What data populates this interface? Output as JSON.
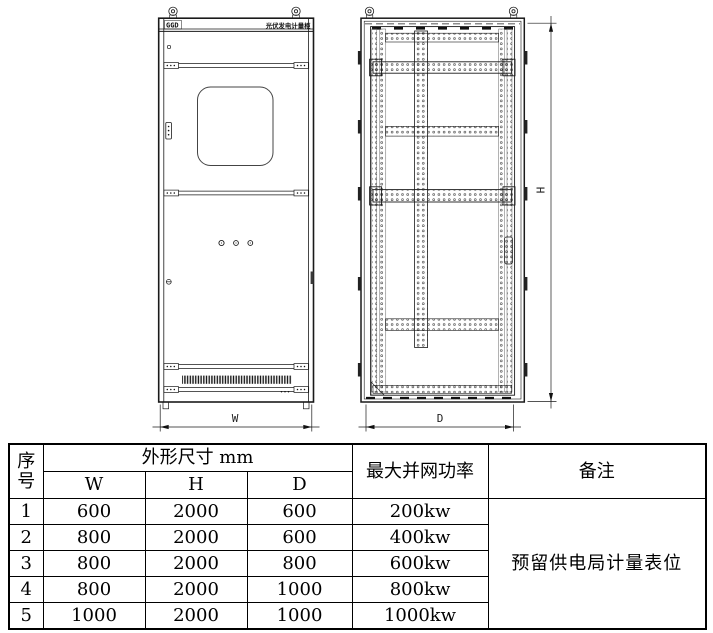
{
  "drawing": {
    "front_view": {
      "logo": "GGD",
      "nameplate": "光伏发电计量柜",
      "width_label": "W"
    },
    "internal_view": {
      "height_label": "H",
      "depth_label": "D"
    }
  },
  "spec_table": {
    "header": {
      "index_line1": "序",
      "index_line2": "号",
      "dimensions_group": "外形尺寸 mm",
      "col_w": "W",
      "col_h": "H",
      "col_d": "D",
      "max_grid_power": "最大并网功率",
      "remarks": "备注"
    },
    "rows": [
      {
        "no": "1",
        "w": "600",
        "h": "2000",
        "d": "600",
        "power": "200kw"
      },
      {
        "no": "2",
        "w": "800",
        "h": "2000",
        "d": "600",
        "power": "400kw"
      },
      {
        "no": "3",
        "w": "800",
        "h": "2000",
        "d": "800",
        "power": "600kw"
      },
      {
        "no": "4",
        "w": "800",
        "h": "2000",
        "d": "1000",
        "power": "800kw"
      },
      {
        "no": "5",
        "w": "1000",
        "h": "2000",
        "d": "1000",
        "power": "1000kw"
      }
    ],
    "remarks_value": "预留供电局计量表位"
  }
}
